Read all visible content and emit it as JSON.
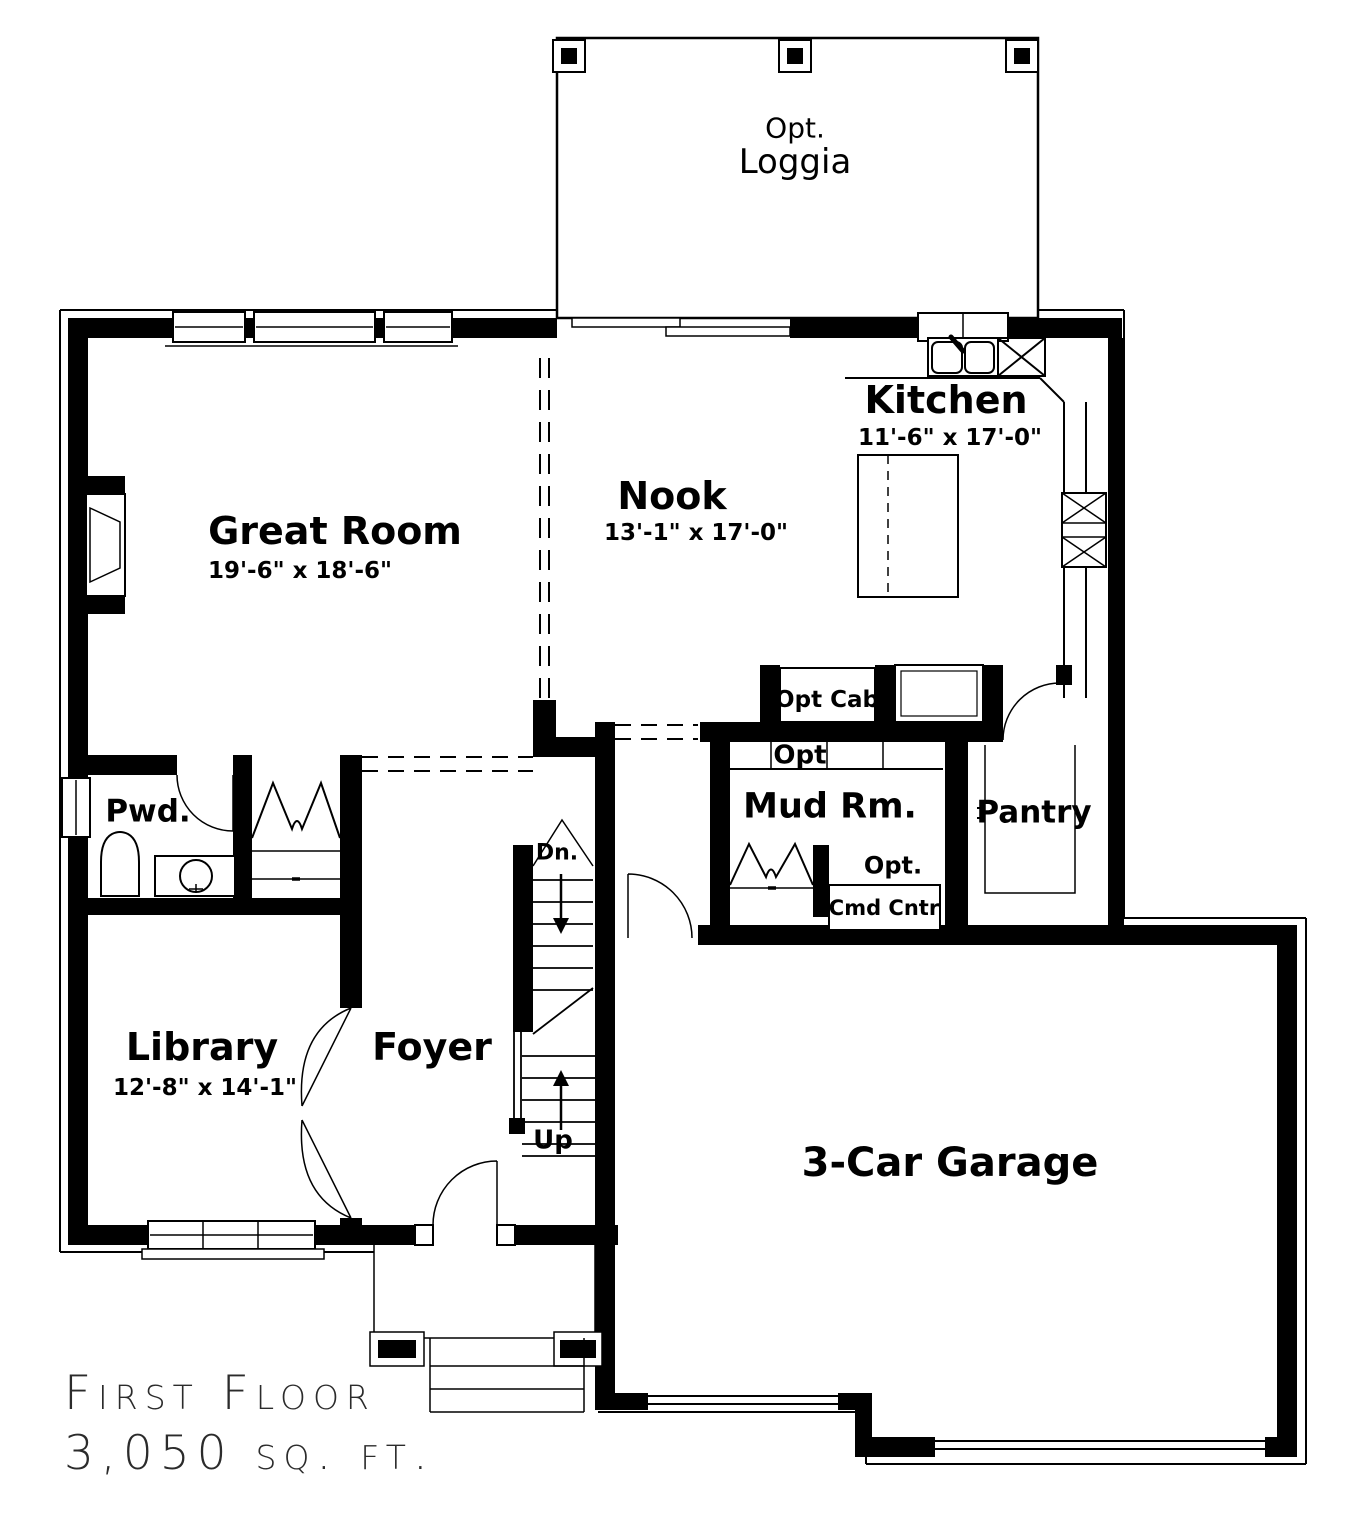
{
  "title": {
    "line1": "First Floor",
    "line2": "3,050 sq. ft."
  },
  "rooms": {
    "loggia": {
      "prefix": "Opt.",
      "name": "Loggia"
    },
    "great_room": {
      "name": "Great Room",
      "dims": "19'-6\" x 18'-6\""
    },
    "nook": {
      "name": "Nook",
      "dims": "13'-1\" x 17'-0\""
    },
    "kitchen": {
      "name": "Kitchen",
      "dims": "11'-6\" x 17'-0\""
    },
    "mud_room": {
      "name": "Mud Rm."
    },
    "pantry": {
      "name": "Pantry"
    },
    "powder": {
      "name": "Pwd."
    },
    "library": {
      "name": "Library",
      "dims": "12'-8\" x 14'-1\""
    },
    "foyer": {
      "name": "Foyer"
    },
    "garage": {
      "name": "3-Car Garage"
    }
  },
  "annotations": {
    "opt_cab": "Opt Cab",
    "opt_bench": "Opt",
    "cmd_prefix": "Opt.",
    "cmd_label": "Cmd Cntr",
    "stairs_down": "Dn.",
    "stairs_up": "Up"
  },
  "colors": {
    "ink": "#000000",
    "paper": "#ffffff"
  }
}
